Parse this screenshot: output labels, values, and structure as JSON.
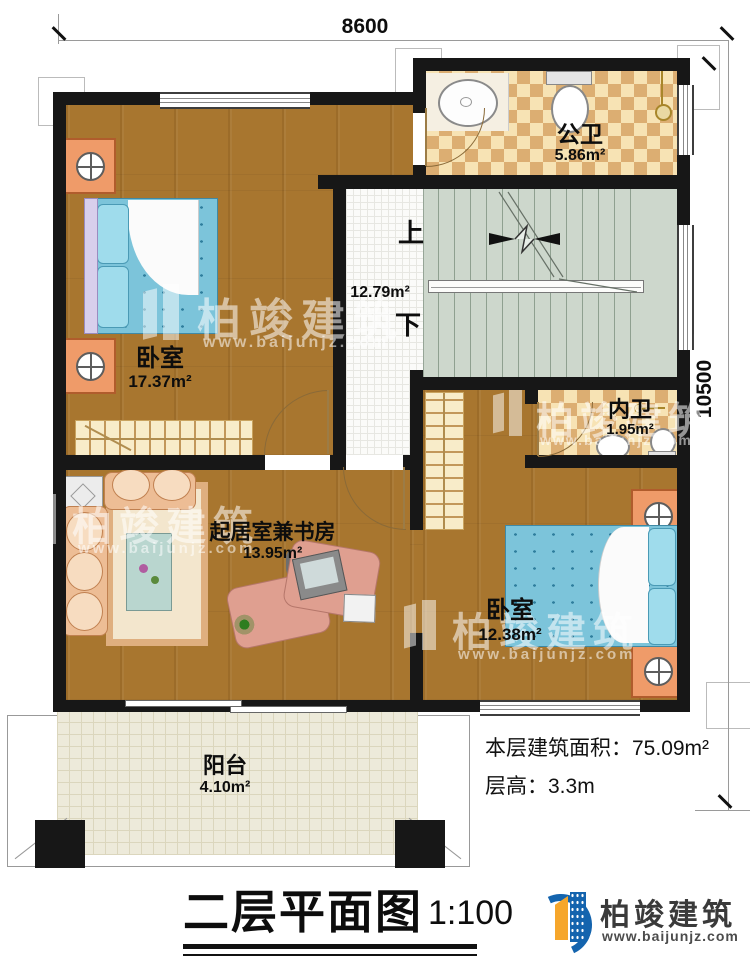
{
  "dimensions": {
    "width_mm": "8600",
    "height_mm": "10500"
  },
  "rooms": {
    "public_bath": {
      "name": "公卫",
      "area": "5.86m²"
    },
    "bedroom_left": {
      "name": "卧室",
      "area": "17.37m²"
    },
    "stairwell": {
      "area": "12.79m²",
      "up_label": "上",
      "down_label": "下"
    },
    "inner_bath": {
      "name": "内卫",
      "area": "1.95m²"
    },
    "bedroom_right": {
      "name": "卧室",
      "area": "12.38m²"
    },
    "living_study": {
      "name": "起居室兼书房",
      "area": "13.95m²"
    },
    "balcony": {
      "name": "阳台",
      "area": "4.10m²"
    }
  },
  "fixtures": {
    "public_bath": [
      "basin",
      "toilet",
      "shower-head"
    ],
    "inner_bath": [
      "basin",
      "toilet",
      "hook"
    ],
    "bedroom_left": [
      "double-bed",
      "nightstand",
      "nightstand",
      "wardrobe"
    ],
    "bedroom_right": [
      "double-bed",
      "nightstand",
      "nightstand",
      "wardrobe"
    ],
    "living_study": [
      "sofa",
      "rug",
      "corner-table",
      "desk",
      "computer",
      "keyboard",
      "office-chair",
      "plant"
    ]
  },
  "notes": {
    "floor_area_label": "本层建筑面积：",
    "floor_area_value": "75.09m²",
    "floor_height_label": "层高：",
    "floor_height_value": "3.3m"
  },
  "footer": {
    "title": "二层平面图",
    "scale": "1:100",
    "brand": "柏竣建筑",
    "website": "www.baijunjz.com"
  },
  "watermark": {
    "brand": "柏竣建筑",
    "website": "www.baijunjz.com"
  },
  "colors": {
    "wall": "#171717",
    "wood_floor": "#a8762f",
    "tile_light": "#f7e3b4",
    "tile_dark": "#dcae72",
    "stair_floor": "#cdd7cc",
    "bed_blue": "#7cc4da",
    "furniture_peach": "#edbd95",
    "logo_blue": "#1464ae",
    "logo_orange": "#f6a62b"
  }
}
